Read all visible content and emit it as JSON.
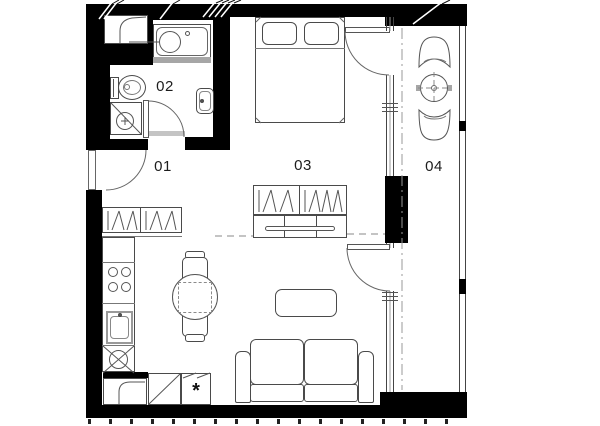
{
  "plan": {
    "type": "apartment-floor-plan",
    "rooms": [
      {
        "number": "01",
        "role": "entry-hall-kitchen"
      },
      {
        "number": "02",
        "role": "bathroom"
      },
      {
        "number": "03",
        "role": "living-sleeping-room"
      },
      {
        "number": "04",
        "role": "balcony"
      }
    ],
    "markers": {
      "appliance_asterisk": "*"
    },
    "colors": {
      "wall": "#000000",
      "line": "#4a4a4a",
      "line_light": "#8a8a8a",
      "background": "#ffffff",
      "fixture_rim": "#a6a6a6"
    },
    "symbols": [
      "bathtub",
      "toilet",
      "shower",
      "washbasin",
      "duct-shaft",
      "double-bed",
      "pillow",
      "wardrobe-hangers",
      "dresser",
      "kitchen-counter",
      "cooktop",
      "kitchen-sink",
      "dining-table",
      "dining-chair",
      "coffee-table",
      "sofa",
      "balcony-table",
      "balcony-chair",
      "door-swing",
      "glazed-wall",
      "railing"
    ]
  }
}
